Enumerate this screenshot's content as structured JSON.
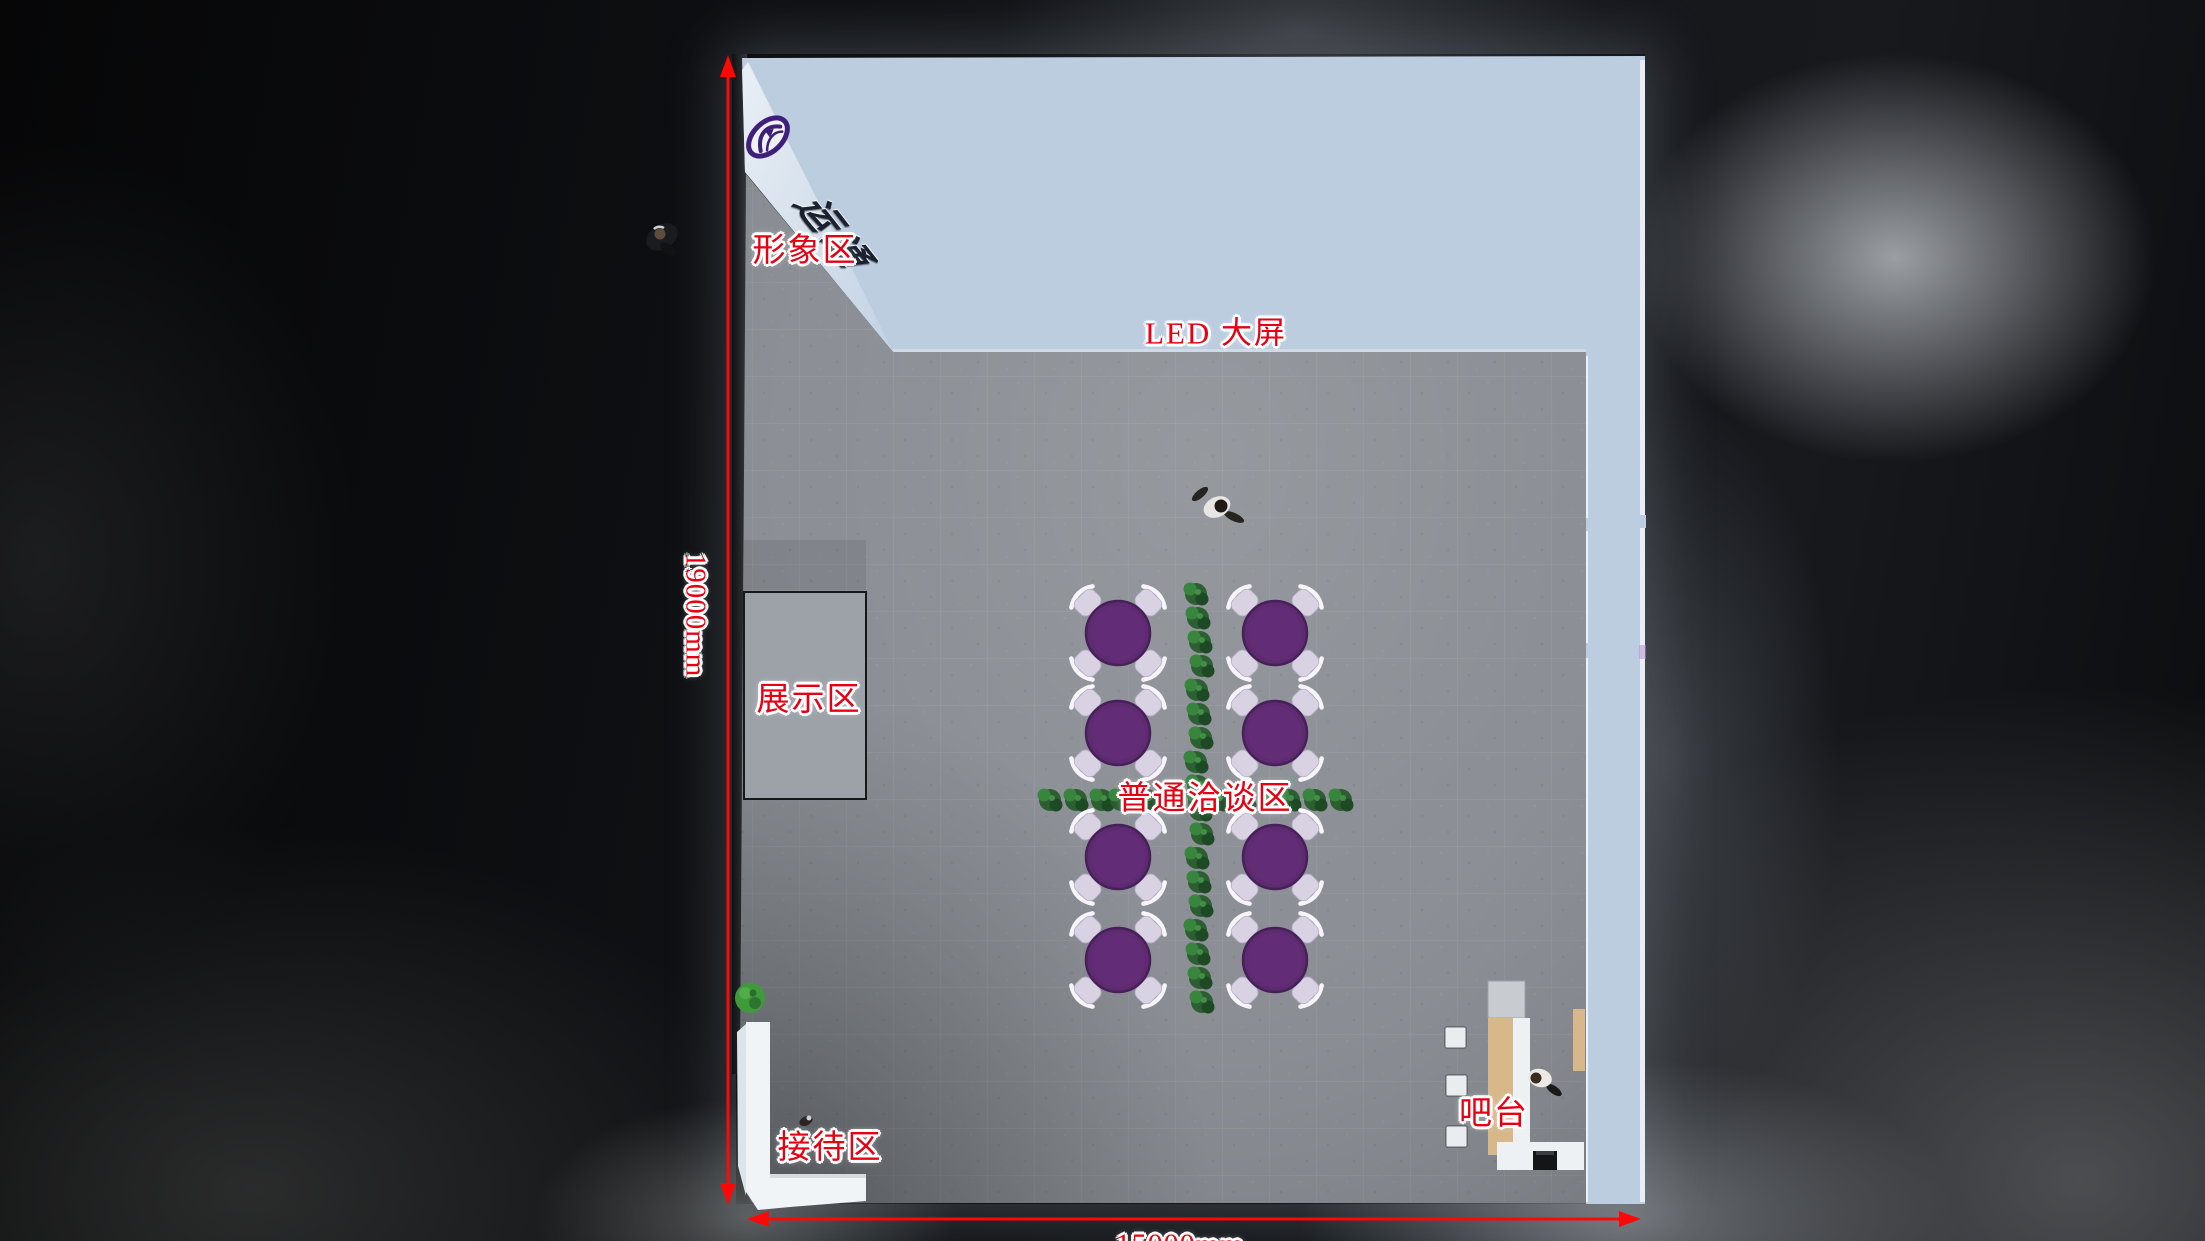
{
  "plan": {
    "area_labels": {
      "image_area": "形象区",
      "led_screen": "LED 大屏",
      "display_area": "展示区",
      "negotiation_area": "普通洽谈区",
      "reception_area": "接待区",
      "bar_area": "吧台"
    },
    "dimensions": {
      "height": "19000mm",
      "width": "15000mm"
    },
    "annotation_color": "#e60012",
    "dimension_line_color": "#ff0707"
  },
  "brand": {
    "logotype": "运通",
    "emblem_icon": "oval-swoosh-badge",
    "emblem_color": "#3f1f7a"
  },
  "colors": {
    "wall_panel": "#bccde0",
    "wall_panel_bright": "#e3ebf2",
    "floor": "#8a8e94",
    "display_platform": "#9da2a9",
    "table_top": "#5e2a70",
    "chair": "#d8d2e2",
    "hedge_green": "#2b6630",
    "counter_wood": "#d8b88b",
    "counter_white": "#eef1f4",
    "reception_desk": "#f1f4f7",
    "background": "#0c0d10"
  },
  "furniture": {
    "round_tables": {
      "count": 8,
      "chairs_per_table": 4,
      "positions": [
        [
          1118,
          633
        ],
        [
          1275,
          633
        ],
        [
          1118,
          733
        ],
        [
          1275,
          733
        ],
        [
          1118,
          857
        ],
        [
          1275,
          857
        ],
        [
          1118,
          960
        ],
        [
          1275,
          960
        ]
      ]
    },
    "hedge_rows": {
      "vertical": {
        "x": 1199,
        "from": 594,
        "to": 1006,
        "step": 24
      },
      "horizontal": {
        "y": 800,
        "from": 1052,
        "to": 1340,
        "step": 24
      }
    },
    "bar_stools": {
      "count": 3,
      "positions": [
        [
          1445,
          1027
        ],
        [
          1446,
          1075
        ],
        [
          1446,
          1126
        ]
      ]
    },
    "people_count": 4
  }
}
